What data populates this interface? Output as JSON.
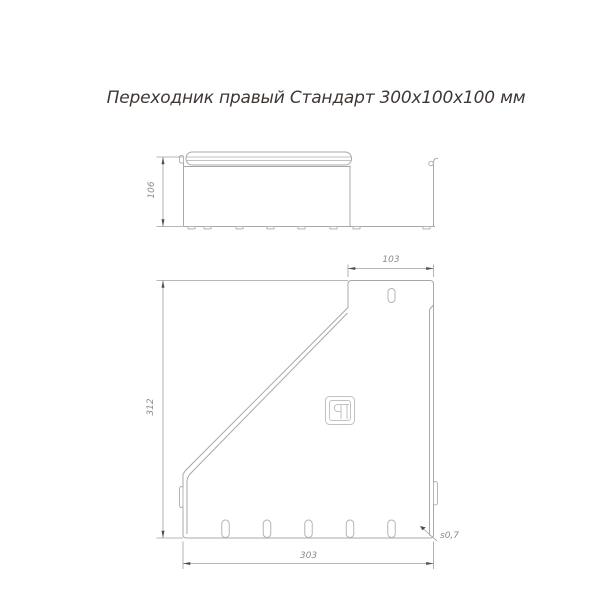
{
  "title": "Переходник правый Стандарт 300х100х100 мм",
  "dimensions": {
    "side_height": "106",
    "top_width": "103",
    "front_height": "312",
    "bottom_width": "303",
    "thickness": "s0,7"
  },
  "logo": {
    "icon": "brand-mark-icon",
    "letters": "ЯП"
  },
  "colors": {
    "background": "#ffffff",
    "line": "#a8a8a8",
    "line_light": "#c2c2c2",
    "dim_line": "#a0a0a0",
    "dim_text": "#8a8a8a",
    "arrow": "#4f4f4f",
    "title_text": "#3e3733"
  }
}
